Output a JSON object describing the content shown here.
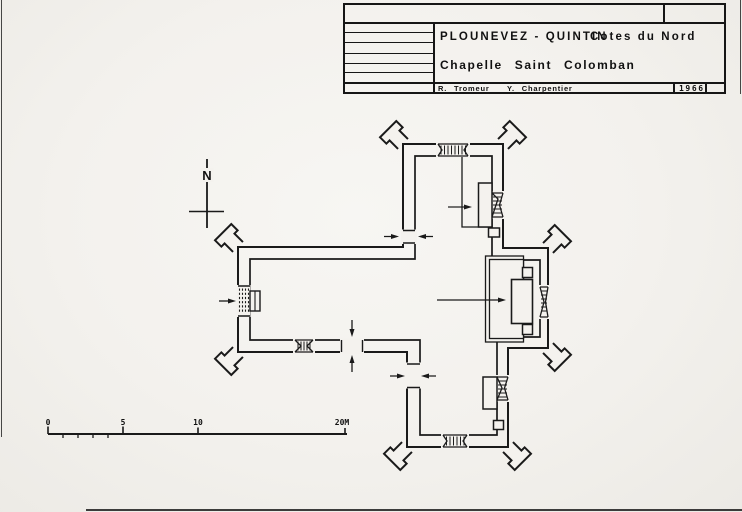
{
  "colors": {
    "ink": "#1a1a1a",
    "paper": "#f4f2ee"
  },
  "title_block": {
    "commune": "PLOUNEVEZ - QUINTIN",
    "department": "Cotes du Nord",
    "subject": "Chapelle Saint Colomban",
    "author_left": "R. Tromeur",
    "author_right": "Y. Charpentier",
    "year": "1966"
  },
  "north_indicator": {
    "label": "N"
  },
  "scale_bar": {
    "labels": [
      "0",
      "5",
      "10",
      "20M"
    ]
  }
}
